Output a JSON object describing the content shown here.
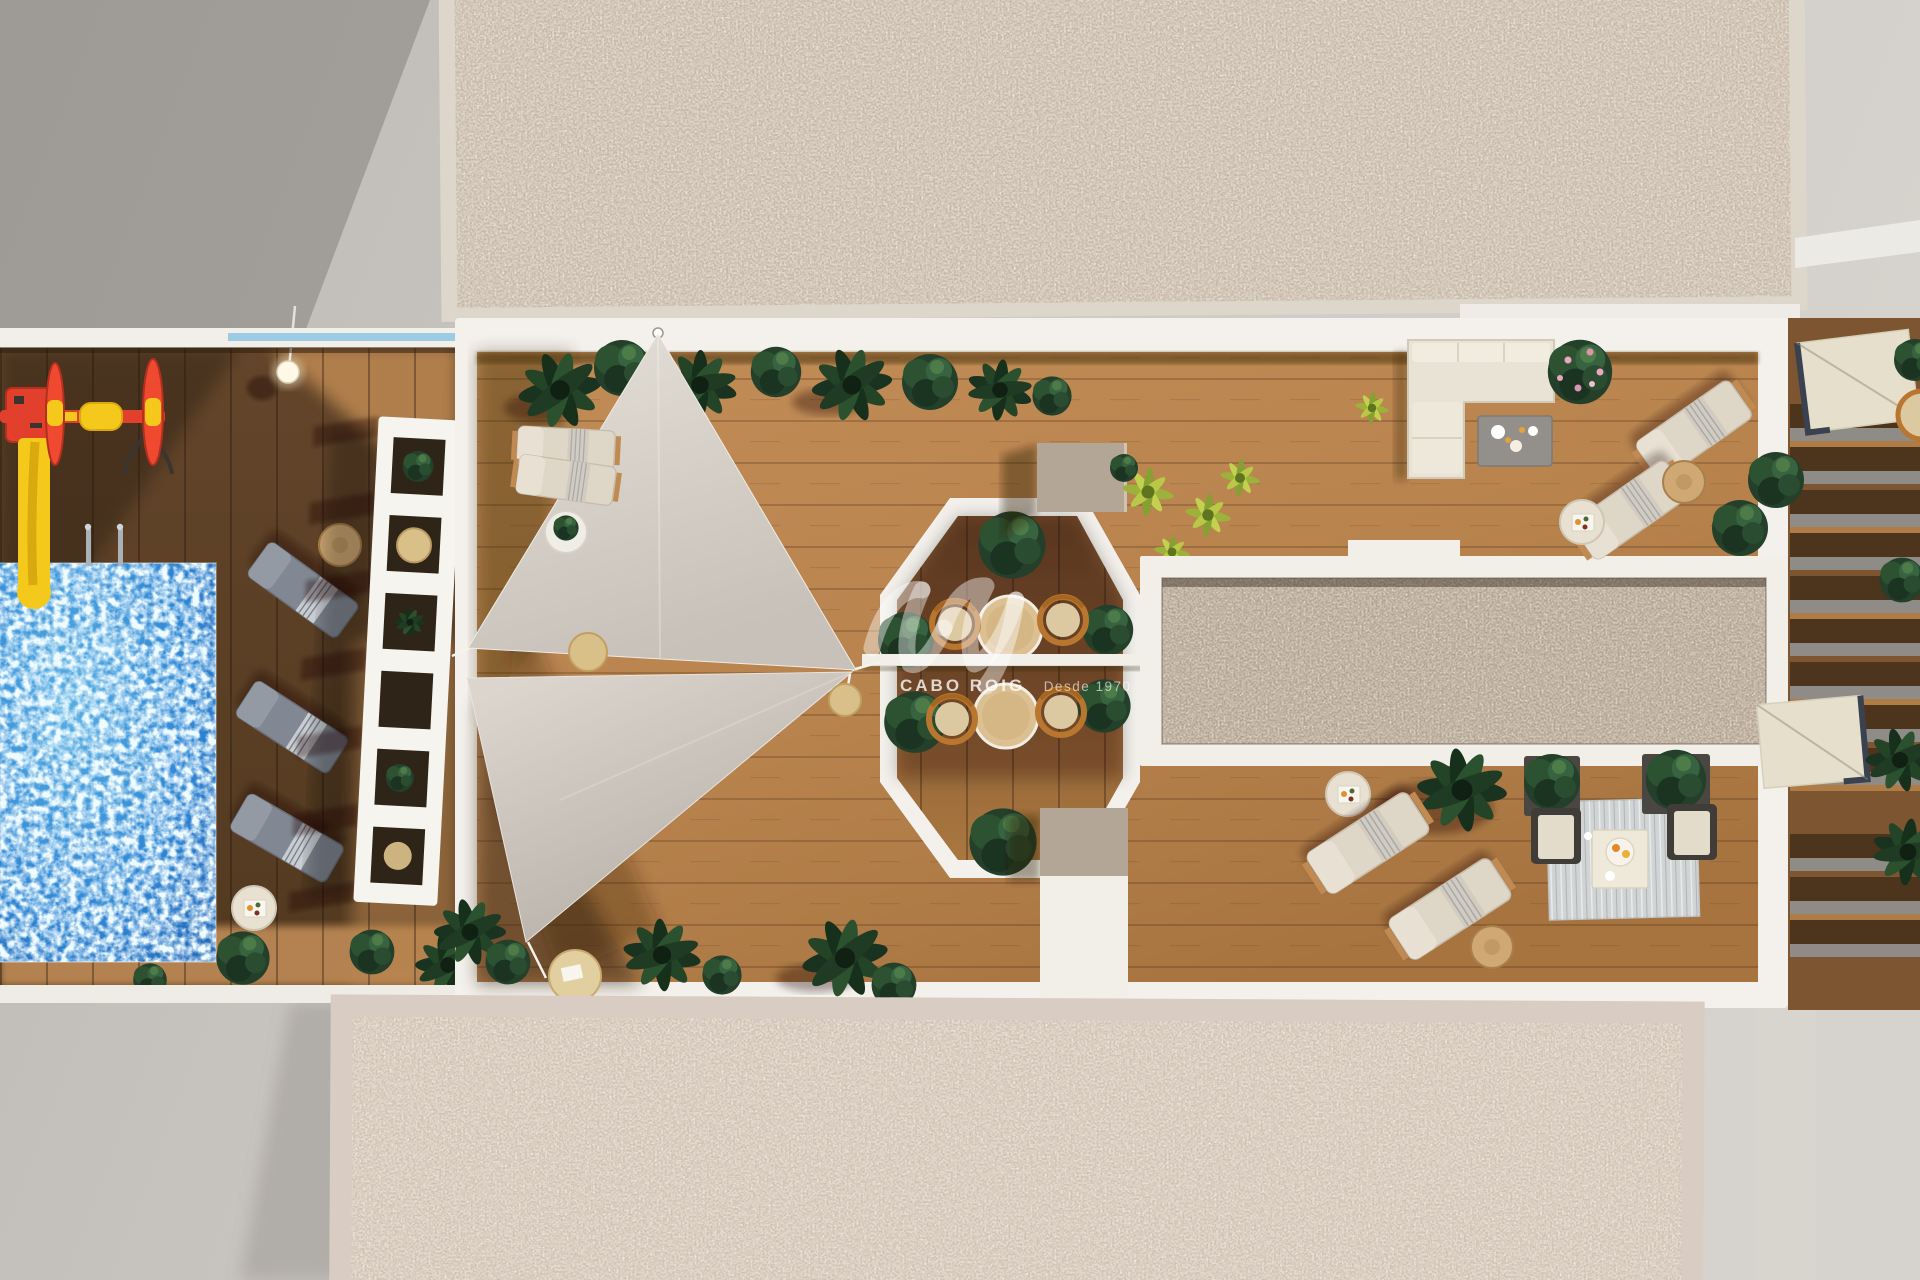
{
  "image": {
    "kind": "top-down aerial 3D architectural render of a residential rooftop / pool terrace",
    "width_px": 1920,
    "height_px": 1280
  },
  "watermark": {
    "brand": "CABO ROIG",
    "tagline": "Desde 1970",
    "logo": "avs-swoosh-icon",
    "color": "#ffffff"
  },
  "palette": {
    "concrete_ground": "#c9c5c0",
    "gravel_roof_top": "#c5b6a6",
    "gravel_roof_bottom": "#cfc0b2",
    "white_trim": "#f4f1ec",
    "deck_wood_sunlit": "#b9854f",
    "deck_wood_shadow": "#5f432a",
    "pool_water": "#2f86d4",
    "shade_sail": "#d8d2ca",
    "foliage_dark": "#24402a",
    "foliage_yellow_green": "#a8bc3e",
    "rattan_orange": "#b8762f",
    "play_red": "#e2402c",
    "play_yellow": "#f4c91c",
    "lounger_gray": "#868d95",
    "lounger_cream": "#ddd5c6",
    "pebble_skylight": "#b2a18f",
    "column_tan": "#b3a697",
    "glass_balustrade": "#8cc4e4"
  },
  "zones": [
    "gravel-roof-top",
    "kids-pool-zone",
    "playground",
    "shade-sail-deck",
    "octagon-pergola-dining",
    "pebble-skylight",
    "sofa-lounge-zone",
    "lounger-corner-zone",
    "side-terrace-pergola",
    "gravel-roof-bottom"
  ]
}
